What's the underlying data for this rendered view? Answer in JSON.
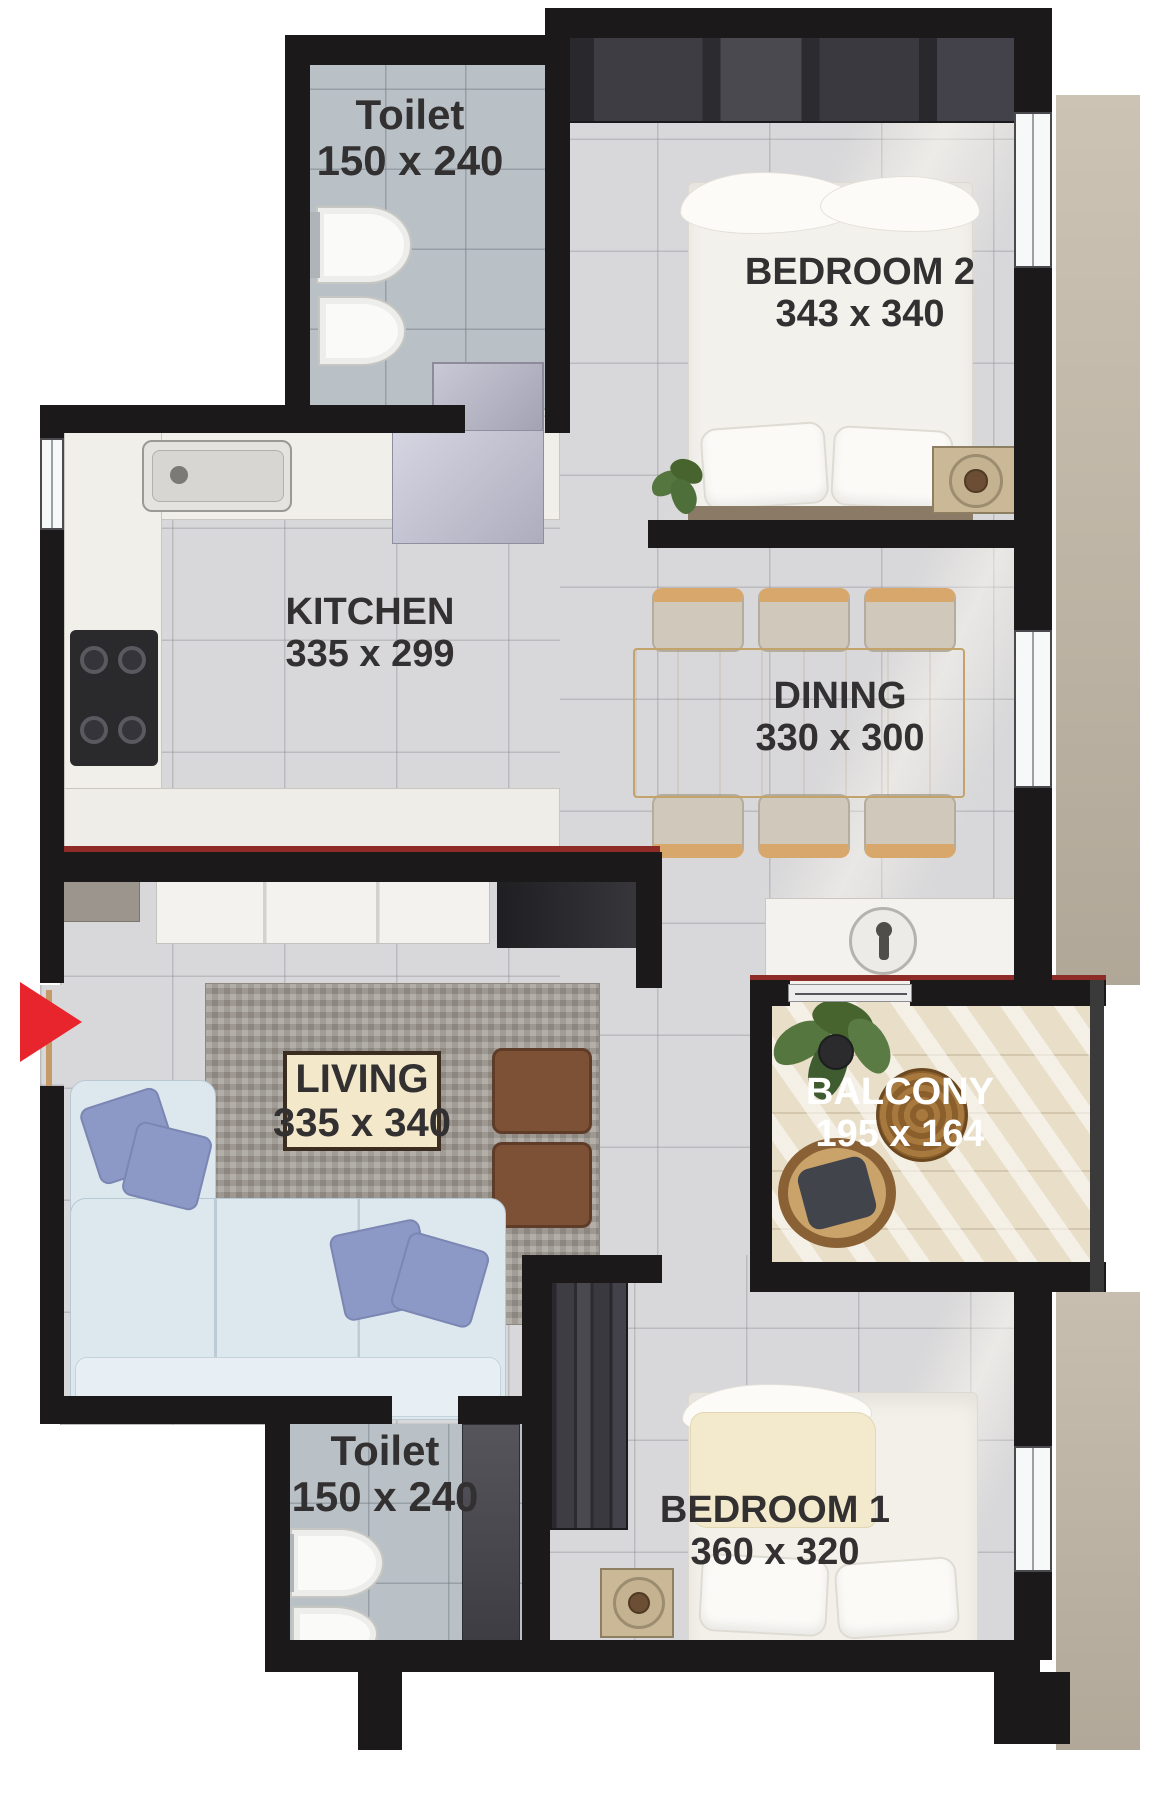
{
  "plan_type": "apartment-floor-plan",
  "colors": {
    "wall": "#1b1919",
    "accent_red": "#e8242d",
    "label_text": "#323030",
    "balcony_label_text": "#ffffff",
    "living_label_bg": "#f4e8ca",
    "floor_tile": "#d8d7d9",
    "bath_tile": "#b9c1c6",
    "balcony_wood": "#e9dfc9",
    "exterior_column": "#c4baab"
  },
  "rooms": [
    {
      "id": "toilet-top",
      "name": "Toilet",
      "dims": "150 x 240"
    },
    {
      "id": "bedroom-2",
      "name": "BEDROOM 2",
      "dims": "343 x 340"
    },
    {
      "id": "kitchen",
      "name": "KITCHEN",
      "dims": "335 x 299"
    },
    {
      "id": "dining",
      "name": "DINING",
      "dims": "330 x 300"
    },
    {
      "id": "living",
      "name": "LIVING",
      "dims": "335 x 340"
    },
    {
      "id": "balcony",
      "name": "BALCONY",
      "dims": "195 x 164"
    },
    {
      "id": "toilet-bottom",
      "name": "Toilet",
      "dims": "150 x 240"
    },
    {
      "id": "bedroom-1",
      "name": "BEDROOM 1",
      "dims": "360 x 320"
    }
  ],
  "entry": {
    "marker": "entry-arrow",
    "direction": "right",
    "color": "#e8242d"
  }
}
